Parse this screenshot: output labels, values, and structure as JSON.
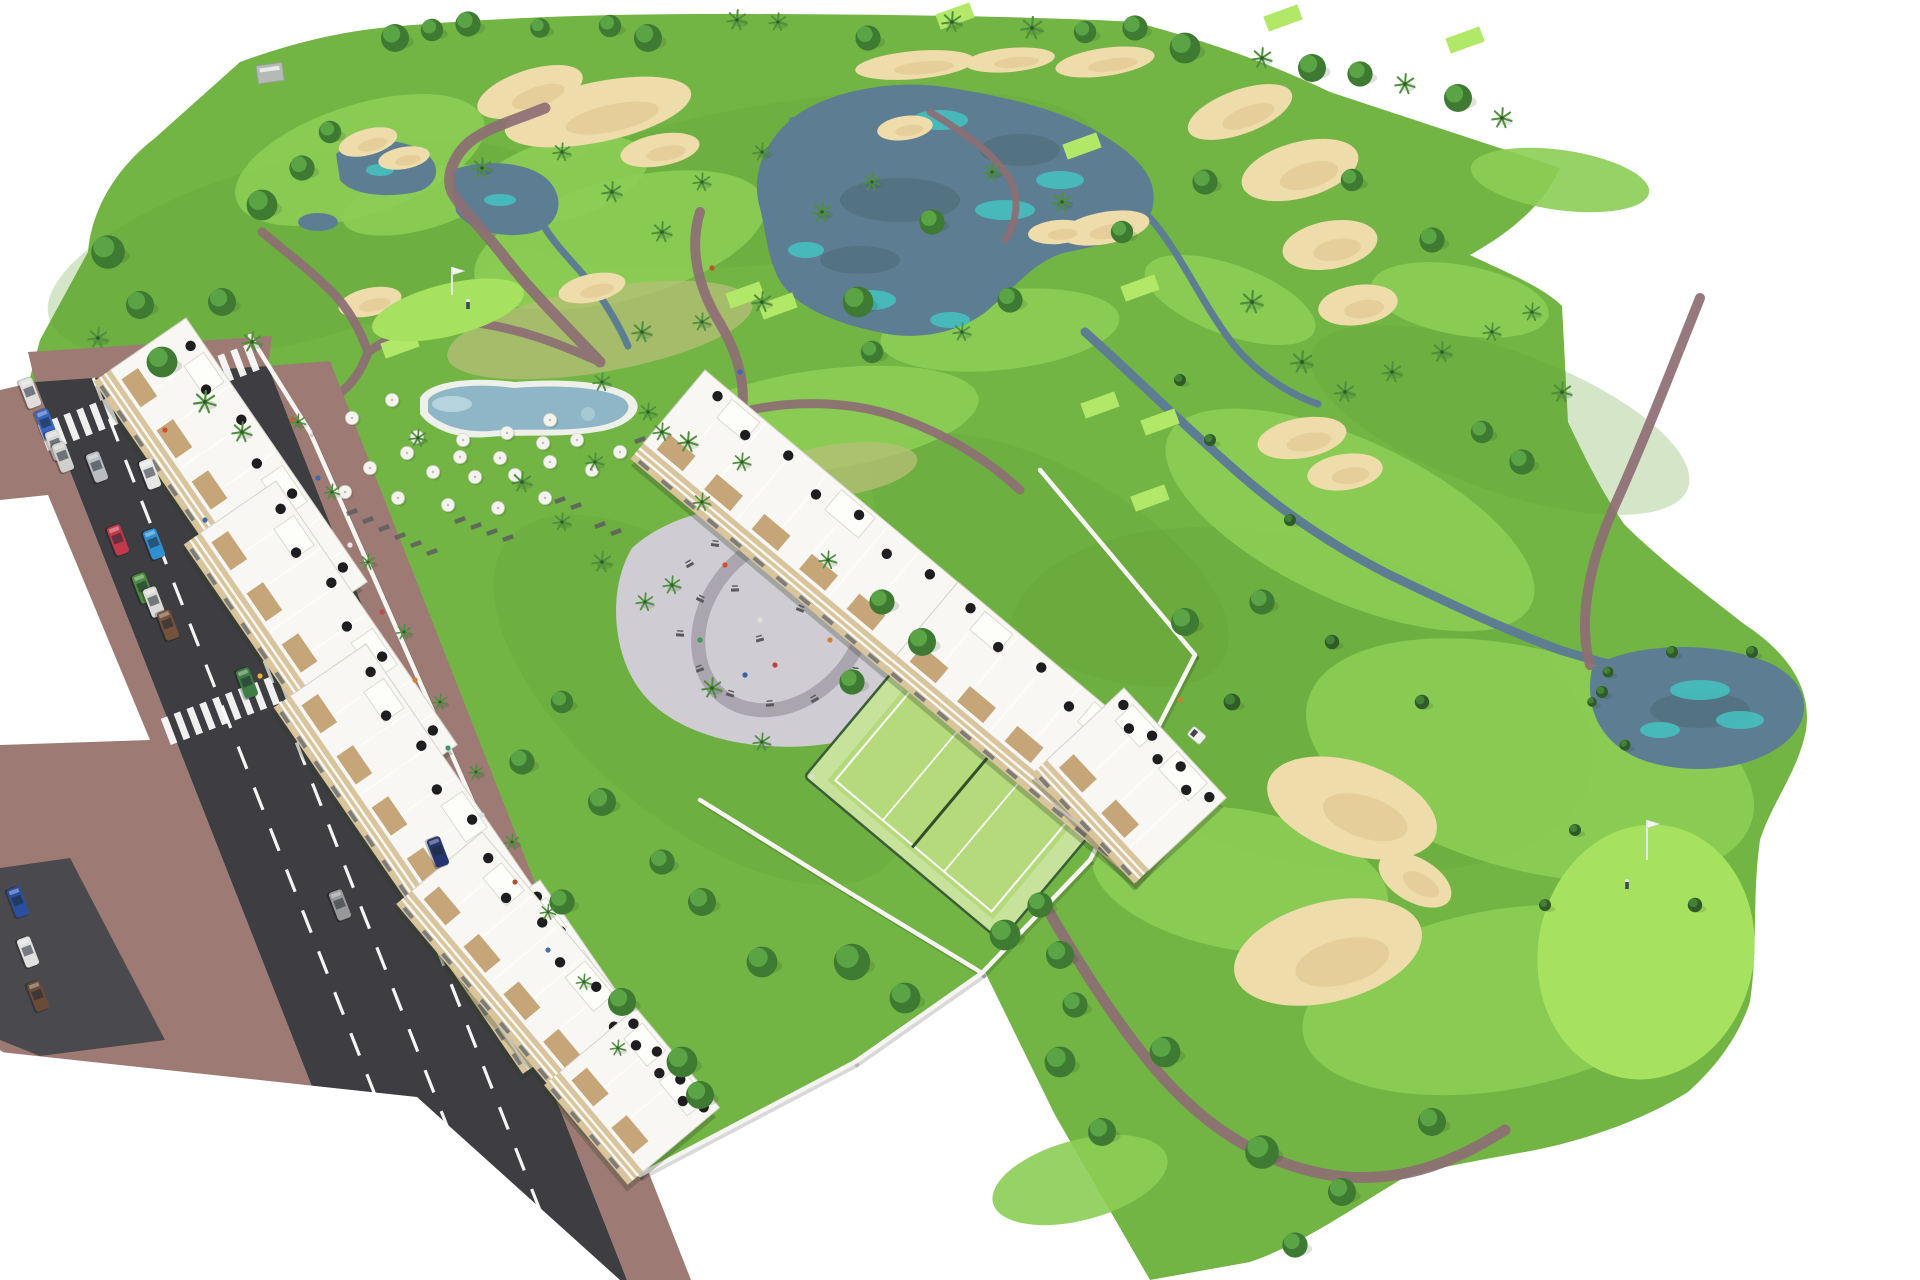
{
  "scene": {
    "title": "Aerial 3D architectural rendering of a golf-resort apartment development",
    "type": "architectural-visualization",
    "visible_text": ""
  },
  "palette": {
    "base_green": "#72b544",
    "fairway_green": "#8ccd55",
    "bright_green": "#a6e25f",
    "tee_green": "#b2e868",
    "rough_green": "#63a13a",
    "dry_grass": "#b7bf78",
    "lake": "#5d7e92",
    "lake_dark": "#51707f",
    "teal": "#43c8c6",
    "sand": "#eedcab",
    "sand_shade": "#dfc48e",
    "path": "#8d6e74",
    "road": "#3d3d42",
    "road_line": "#ffffff",
    "sidewalk": "#9d7b74",
    "apron": "#4a4a4e",
    "wall": "#f6f5f1",
    "building": "#f8f7f3",
    "building_edge": "#d6d3ca",
    "facade_beige": "#d9c49c",
    "window": "#6b7075",
    "wood": "#c3a172",
    "umbrella_black": "#1e1e20",
    "umbrella_white": "#f4f3ee",
    "pool_water": "#8fb6c6",
    "pool_aqua": "#bcd9e2",
    "deck": "#eef0ea",
    "plaza": "#cfccd3",
    "plaza_ring": "#a8a2ac",
    "equipment": "#5a5a5e",
    "court_surface": "#c7e29b",
    "court_inner": "#b4da7c",
    "court_line": "#ffffff",
    "fence": "#3a5f38",
    "tree_base": "#3e7a31",
    "tree_hi": "#5ea849",
    "tree_dark": "#2e5b27",
    "tree_dark_hi": "#47853a",
    "palm": "#4e8f3e",
    "trunk": "#7a5c42",
    "shrub": "#6fae4a",
    "shadow": "rgba(45,60,35,0.28)",
    "flag_pole": "#e8e8e8",
    "cart": "#f2f2f0"
  },
  "rough_patches": [
    [
      300,
      250,
      260,
      90,
      -15
    ],
    [
      800,
      180,
      300,
      80,
      -8
    ],
    [
      1300,
      700,
      300,
      160,
      15
    ],
    [
      700,
      700,
      250,
      120,
      40
    ],
    [
      1500,
      420,
      200,
      70,
      20
    ],
    [
      1050,
      560,
      200,
      90,
      30
    ]
  ],
  "fairways": [
    [
      360,
      160,
      130,
      55,
      -18
    ],
    [
      620,
      240,
      150,
      60,
      -15
    ],
    [
      820,
      420,
      160,
      50,
      -8
    ],
    [
      560,
      180,
      90,
      40,
      -15
    ],
    [
      1000,
      330,
      120,
      40,
      -6
    ],
    [
      900,
      180,
      120,
      45,
      -10
    ],
    [
      1350,
      520,
      200,
      80,
      25
    ],
    [
      1530,
      760,
      230,
      110,
      15
    ],
    [
      1500,
      1000,
      200,
      90,
      -10
    ],
    [
      1240,
      880,
      150,
      70,
      10
    ],
    [
      1080,
      1180,
      90,
      40,
      -15
    ],
    [
      260,
      420,
      60,
      25,
      -20
    ],
    [
      1460,
      300,
      90,
      35,
      10
    ],
    [
      1560,
      180,
      90,
      30,
      8
    ],
    [
      1230,
      300,
      90,
      35,
      20
    ],
    [
      420,
      200,
      80,
      30,
      -15
    ]
  ],
  "dry_patches": [
    [
      600,
      330,
      155,
      42,
      -10
    ],
    [
      838,
      470,
      80,
      26,
      -8
    ]
  ],
  "teal_patches": [
    [
      940,
      120,
      28,
      10
    ],
    [
      1060,
      180,
      24,
      9
    ],
    [
      870,
      300,
      26,
      10
    ],
    [
      950,
      320,
      20,
      8
    ],
    [
      806,
      250,
      18,
      8
    ],
    [
      1005,
      210,
      30,
      10
    ],
    [
      1700,
      690,
      30,
      10
    ],
    [
      1740,
      720,
      24,
      9
    ],
    [
      1660,
      730,
      20,
      8
    ],
    [
      500,
      200,
      16,
      6
    ],
    [
      380,
      170,
      14,
      6
    ]
  ],
  "lake_reflections": [
    [
      900,
      200,
      60,
      22
    ],
    [
      1020,
      150,
      40,
      16
    ],
    [
      860,
      260,
      40,
      14
    ],
    [
      1700,
      710,
      50,
      18
    ]
  ],
  "bunkers": [
    [
      598,
      112,
      95,
      30,
      -12
    ],
    [
      530,
      92,
      55,
      22,
      -18
    ],
    [
      660,
      150,
      40,
      16,
      -10
    ],
    [
      368,
      142,
      30,
      13,
      -15
    ],
    [
      404,
      158,
      26,
      11,
      -10
    ],
    [
      915,
      65,
      60,
      14,
      -5
    ],
    [
      1010,
      60,
      45,
      12,
      -5
    ],
    [
      1105,
      62,
      50,
      14,
      -8
    ],
    [
      905,
      128,
      28,
      12,
      -8
    ],
    [
      1240,
      112,
      55,
      22,
      -20
    ],
    [
      1300,
      170,
      60,
      28,
      -15
    ],
    [
      1330,
      245,
      48,
      24,
      -10
    ],
    [
      1358,
      305,
      40,
      20,
      -8
    ],
    [
      1105,
      228,
      45,
      16,
      -10
    ],
    [
      1058,
      232,
      30,
      12,
      -5
    ],
    [
      370,
      302,
      32,
      14,
      -12
    ],
    [
      592,
      288,
      34,
      14,
      -12
    ],
    [
      1302,
      438,
      45,
      20,
      -10
    ],
    [
      1345,
      472,
      38,
      18,
      -8
    ],
    [
      1352,
      808,
      88,
      46,
      18
    ],
    [
      1328,
      952,
      96,
      50,
      -14
    ],
    [
      1415,
      880,
      40,
      22,
      30
    ]
  ],
  "tee_boxes": [
    [
      248,
      462
    ],
    [
      400,
      345
    ],
    [
      745,
      295
    ],
    [
      778,
      306
    ],
    [
      955,
      16
    ],
    [
      1082,
      146
    ],
    [
      1140,
      288
    ],
    [
      1100,
      405
    ],
    [
      1160,
      422
    ],
    [
      1465,
      40
    ],
    [
      1283,
      18
    ],
    [
      1150,
      498
    ]
  ],
  "putting_greens": [
    [
      448,
      310,
      78,
      26,
      -14
    ],
    [
      1646,
      952,
      108,
      128,
      10
    ]
  ],
  "golf_flags": [
    {
      "x": 452,
      "y": 295,
      "h": 28,
      "golfer_x": 468,
      "golfer_y": 306
    },
    {
      "x": 1647,
      "y": 860,
      "h": 40,
      "golfer_x": 1627,
      "golfer_y": 886
    }
  ],
  "golf_cart": {
    "x": 1197,
    "y": 735,
    "angle": 40
  },
  "road": {
    "axis_top_left": [
      35,
      382
    ],
    "axis_top_right": [
      268,
      366
    ],
    "slope_dx_per_dy": 0.393,
    "lane_line_fractions": [
      0.25,
      0.5,
      0.75
    ],
    "crosswalks": [
      [
        152,
        396
      ],
      [
        275,
        690
      ]
    ],
    "car_angle": 69
  },
  "cars": [
    [
      30,
      393,
      "#dedede"
    ],
    [
      46,
      424,
      "#3a66c0"
    ],
    [
      56,
      445,
      "#d8d8d6"
    ],
    [
      63,
      457,
      "#cfcfcd"
    ],
    [
      97,
      467,
      "#b9bcc0"
    ],
    [
      150,
      474,
      "#e6e6e4"
    ],
    [
      118,
      540,
      "#c03a4a"
    ],
    [
      154,
      544,
      "#2f8fd0"
    ],
    [
      143,
      588,
      "#4a8a3c"
    ],
    [
      154,
      602,
      "#dadad8"
    ],
    [
      168,
      625,
      "#76523c"
    ],
    [
      247,
      683,
      "#3f7d46"
    ],
    [
      18,
      902,
      "#2a4fa0"
    ],
    [
      28,
      952,
      "#e0e0e0"
    ],
    [
      38,
      996,
      "#6a4a38"
    ],
    [
      340,
      905,
      "#98989a"
    ],
    [
      438,
      852,
      "#27356e"
    ]
  ],
  "walls": [
    [
      310,
      432,
      580,
      1046
    ],
    [
      250,
      336,
      310,
      432
    ],
    [
      700,
      800,
      850,
      893
    ],
    [
      850,
      893,
      982,
      973
    ],
    [
      982,
      973,
      855,
      1062
    ],
    [
      855,
      1062,
      640,
      1175
    ],
    [
      580,
      1046,
      640,
      1175
    ],
    [
      1040,
      470,
      1195,
      655
    ],
    [
      1195,
      655,
      1090,
      860
    ],
    [
      1090,
      860,
      982,
      973
    ]
  ],
  "buildings": [
    {
      "x": 186,
      "y": 318,
      "a": 55.5,
      "len": 320,
      "dep": 92
    },
    {
      "x": 276,
      "y": 481,
      "a": 55.5,
      "len": 320,
      "dep": 92
    },
    {
      "x": 366,
      "y": 644,
      "a": 55.5,
      "len": 320,
      "dep": 92
    },
    {
      "x": 540,
      "y": 880,
      "a": 55.5,
      "len": 150,
      "dep": 104
    },
    {
      "x": 705,
      "y": 370,
      "a": 40,
      "len": 330,
      "dep": 96
    },
    {
      "x": 958,
      "y": 582,
      "a": 40,
      "len": 330,
      "dep": 96
    },
    {
      "x": 1124,
      "y": 688,
      "a": 47,
      "len": 150,
      "dep": 106
    },
    {
      "x": 482,
      "y": 832,
      "a": 50,
      "len": 300,
      "dep": 92
    },
    {
      "x": 636,
      "y": 1008,
      "a": 50,
      "len": 130,
      "dep": 100
    }
  ],
  "rooftop_umbrella_fractions": [
    0.08,
    0.22,
    0.36,
    0.5,
    0.64,
    0.78,
    0.92
  ],
  "pool_umbrellas": [
    [
      392,
      400
    ],
    [
      352,
      418
    ],
    [
      417,
      437
    ],
    [
      463,
      440
    ],
    [
      507,
      433
    ],
    [
      550,
      420
    ],
    [
      577,
      440
    ],
    [
      460,
      457
    ],
    [
      500,
      458
    ],
    [
      543,
      443
    ],
    [
      475,
      477
    ],
    [
      515,
      475
    ],
    [
      407,
      453
    ],
    [
      433,
      472
    ],
    [
      550,
      462
    ],
    [
      592,
      470
    ],
    [
      620,
      452
    ],
    [
      648,
      462
    ],
    [
      370,
      468
    ],
    [
      345,
      492
    ],
    [
      398,
      498
    ],
    [
      448,
      505
    ],
    [
      498,
      508
    ],
    [
      545,
      498
    ]
  ],
  "loungers": [
    [
      352,
      512
    ],
    [
      368,
      520
    ],
    [
      384,
      528
    ],
    [
      400,
      536
    ],
    [
      416,
      544
    ],
    [
      432,
      552
    ],
    [
      460,
      520
    ],
    [
      476,
      526
    ],
    [
      492,
      532
    ],
    [
      508,
      538
    ],
    [
      560,
      500
    ],
    [
      576,
      506
    ],
    [
      640,
      440
    ],
    [
      658,
      450
    ],
    [
      600,
      525
    ],
    [
      616,
      532
    ]
  ],
  "playground_equipment": [
    [
      690,
      565
    ],
    [
      715,
      545
    ],
    [
      745,
      530
    ],
    [
      775,
      545
    ],
    [
      810,
      535
    ],
    [
      845,
      560
    ],
    [
      870,
      590
    ],
    [
      880,
      625
    ],
    [
      700,
      600
    ],
    [
      680,
      635
    ],
    [
      700,
      670
    ],
    [
      730,
      695
    ],
    [
      770,
      705
    ],
    [
      815,
      700
    ],
    [
      855,
      672
    ],
    [
      760,
      640
    ],
    [
      800,
      610
    ],
    [
      735,
      590
    ]
  ],
  "playground_people": [
    [
      725,
      565,
      "#d05030"
    ],
    [
      795,
      580,
      "#3068c0"
    ],
    [
      760,
      620,
      "#e0e0e0"
    ],
    [
      830,
      640,
      "#d08030"
    ],
    [
      700,
      640,
      "#3a9a50"
    ],
    [
      775,
      665,
      "#c04040"
    ],
    [
      745,
      675,
      "#3a5f9a"
    ],
    [
      860,
      610,
      "#e8e8e8"
    ]
  ],
  "pedestrians": [
    [
      292,
      420,
      "#d06030"
    ],
    [
      318,
      478,
      "#3a6ab0"
    ],
    [
      350,
      545,
      "#e8e8e6"
    ],
    [
      382,
      612,
      "#c04848"
    ],
    [
      415,
      680,
      "#d08030"
    ],
    [
      448,
      748,
      "#3a9a70"
    ],
    [
      482,
      815,
      "#e0e0e0"
    ],
    [
      515,
      882,
      "#b05030"
    ],
    [
      548,
      950,
      "#4a70b0"
    ],
    [
      260,
      676,
      "#e8b830"
    ],
    [
      165,
      430,
      "#d05030"
    ],
    [
      205,
      520,
      "#3a6ab0"
    ],
    [
      712,
      268,
      "#c05030"
    ],
    [
      740,
      372,
      "#3a6ab0"
    ],
    [
      1180,
      700,
      "#d08030"
    ]
  ],
  "clubhouse": {
    "x": 256,
    "y": 66,
    "w": 26,
    "h": 18
  },
  "trees": [
    [
      395,
      38,
      "R",
      1
    ],
    [
      432,
      30,
      "R",
      0.8
    ],
    [
      468,
      24,
      "R",
      0.9
    ],
    [
      540,
      28,
      "R",
      0.7
    ],
    [
      610,
      26,
      "R",
      0.8
    ],
    [
      648,
      38,
      "R",
      1
    ],
    [
      737,
      20,
      "P",
      0.9
    ],
    [
      778,
      22,
      "P",
      0.8
    ],
    [
      868,
      38,
      "R",
      0.9
    ],
    [
      952,
      22,
      "P",
      0.9
    ],
    [
      1032,
      28,
      "P",
      1
    ],
    [
      1085,
      32,
      "R",
      0.8
    ],
    [
      1135,
      28,
      "R",
      0.9
    ],
    [
      1185,
      48,
      "R",
      1.1
    ],
    [
      1262,
      58,
      "P",
      0.9
    ],
    [
      1312,
      68,
      "R",
      1
    ],
    [
      1360,
      74,
      "R",
      0.9
    ],
    [
      1405,
      84,
      "P",
      0.9
    ],
    [
      1458,
      98,
      "R",
      1
    ],
    [
      1502,
      118,
      "P",
      0.9
    ],
    [
      108,
      252,
      "R",
      1.2
    ],
    [
      140,
      305,
      "R",
      1
    ],
    [
      98,
      338,
      "P",
      0.9
    ],
    [
      162,
      362,
      "R",
      1.1
    ],
    [
      222,
      302,
      "R",
      1
    ],
    [
      262,
      205,
      "R",
      1.1
    ],
    [
      302,
      168,
      "R",
      0.9
    ],
    [
      252,
      342,
      "P",
      0.9
    ],
    [
      205,
      402,
      "P",
      1
    ],
    [
      242,
      432,
      "P",
      0.9
    ],
    [
      330,
      132,
      "R",
      0.8
    ],
    [
      482,
      168,
      "P",
      0.9
    ],
    [
      562,
      152,
      "P",
      0.8
    ],
    [
      612,
      192,
      "P",
      0.9
    ],
    [
      662,
      232,
      "P",
      0.9
    ],
    [
      702,
      182,
      "P",
      0.8
    ],
    [
      762,
      152,
      "P",
      0.8
    ],
    [
      822,
      212,
      "P",
      0.9
    ],
    [
      872,
      182,
      "P",
      0.8
    ],
    [
      932,
      222,
      "R",
      0.9
    ],
    [
      992,
      172,
      "P",
      0.8
    ],
    [
      1062,
      202,
      "P",
      0.9
    ],
    [
      1122,
      232,
      "R",
      0.8
    ],
    [
      762,
      302,
      "P",
      0.9
    ],
    [
      702,
      322,
      "P",
      0.8
    ],
    [
      642,
      332,
      "P",
      0.9
    ],
    [
      872,
      352,
      "R",
      0.8
    ],
    [
      962,
      332,
      "P",
      0.8
    ],
    [
      858,
      302,
      "R",
      1.1
    ],
    [
      1010,
      300,
      "R",
      0.9
    ],
    [
      1205,
      182,
      "R",
      0.9
    ],
    [
      1252,
      302,
      "P",
      1
    ],
    [
      1302,
      362,
      "P",
      1
    ],
    [
      1345,
      392,
      "P",
      0.9
    ],
    [
      1392,
      372,
      "P",
      0.9
    ],
    [
      1442,
      352,
      "P",
      0.9
    ],
    [
      1492,
      332,
      "P",
      0.8
    ],
    [
      1532,
      312,
      "P",
      0.8
    ],
    [
      1562,
      392,
      "P",
      0.9
    ],
    [
      1482,
      432,
      "R",
      0.8
    ],
    [
      1522,
      462,
      "R",
      0.9
    ],
    [
      1432,
      240,
      "R",
      0.9
    ],
    [
      1352,
      180,
      "R",
      0.8
    ],
    [
      1210,
      440,
      "D",
      0.5
    ],
    [
      1290,
      520,
      "D",
      0.5
    ],
    [
      1180,
      380,
      "D",
      0.5
    ],
    [
      1185,
      622,
      "R",
      1
    ],
    [
      1262,
      602,
      "R",
      0.9
    ],
    [
      1232,
      702,
      "D",
      0.7
    ],
    [
      1165,
      1052,
      "R",
      1.1
    ],
    [
      1262,
      1152,
      "R",
      1.2
    ],
    [
      1342,
      1192,
      "R",
      1
    ],
    [
      1295,
      1245,
      "R",
      0.9
    ],
    [
      1432,
      1122,
      "R",
      1
    ],
    [
      1102,
      1132,
      "R",
      1
    ],
    [
      1060,
      1062,
      "R",
      1.1
    ],
    [
      1075,
      1005,
      "R",
      0.9
    ],
    [
      1332,
      642,
      "D",
      0.6
    ],
    [
      1422,
      702,
      "D",
      0.6
    ],
    [
      1602,
      692,
      "D",
      0.5
    ],
    [
      1672,
      652,
      "D",
      0.5
    ],
    [
      1752,
      652,
      "D",
      0.5
    ],
    [
      1575,
      830,
      "D",
      0.5
    ],
    [
      1545,
      905,
      "D",
      0.5
    ],
    [
      1695,
      905,
      "D",
      0.6
    ],
    [
      1608,
      672,
      "D",
      0.45
    ],
    [
      1592,
      702,
      "D",
      0.4
    ],
    [
      1625,
      745,
      "D",
      0.45
    ],
    [
      522,
      482,
      "P",
      0.9
    ],
    [
      562,
      522,
      "P",
      0.8
    ],
    [
      602,
      562,
      "P",
      0.9
    ],
    [
      645,
      602,
      "P",
      0.8
    ],
    [
      702,
      502,
      "P",
      0.8
    ],
    [
      742,
      462,
      "P",
      0.8
    ],
    [
      662,
      432,
      "P",
      0.8
    ],
    [
      602,
      382,
      "P",
      0.8
    ],
    [
      882,
      602,
      "R",
      0.9
    ],
    [
      922,
      642,
      "R",
      1
    ],
    [
      852,
      682,
      "R",
      0.9
    ],
    [
      562,
      702,
      "R",
      0.8
    ],
    [
      522,
      762,
      "R",
      0.9
    ],
    [
      602,
      802,
      "R",
      1
    ],
    [
      662,
      862,
      "R",
      0.9
    ],
    [
      702,
      902,
      "R",
      1
    ],
    [
      762,
      962,
      "R",
      1.1
    ],
    [
      562,
      902,
      "R",
      0.9
    ],
    [
      622,
      1002,
      "R",
      1
    ],
    [
      682,
      1062,
      "R",
      1.1
    ],
    [
      700,
      1095,
      "R",
      1
    ],
    [
      852,
      962,
      "R",
      1.3
    ],
    [
      905,
      998,
      "R",
      1.1
    ],
    [
      1005,
      935,
      "R",
      1.1
    ],
    [
      1060,
      955,
      "R",
      1
    ],
    [
      1040,
      905,
      "R",
      0.9
    ],
    [
      298,
      422,
      "P",
      0.7
    ],
    [
      332,
      492,
      "P",
      0.7
    ],
    [
      368,
      562,
      "P",
      0.7
    ],
    [
      404,
      632,
      "P",
      0.7
    ],
    [
      440,
      702,
      "P",
      0.7
    ],
    [
      476,
      772,
      "P",
      0.7
    ],
    [
      512,
      842,
      "P",
      0.7
    ],
    [
      548,
      912,
      "P",
      0.7
    ],
    [
      584,
      982,
      "P",
      0.7
    ],
    [
      618,
      1048,
      "P",
      0.7
    ],
    [
      418,
      438,
      "P",
      0.8
    ],
    [
      648,
      412,
      "P",
      0.8
    ],
    [
      688,
      442,
      "P",
      0.9
    ],
    [
      595,
      462,
      "P",
      0.8
    ],
    [
      672,
      585,
      "P",
      0.8
    ],
    [
      712,
      688,
      "P",
      0.9
    ],
    [
      762,
      742,
      "P",
      0.8
    ],
    [
      828,
      560,
      "P",
      0.8
    ]
  ]
}
